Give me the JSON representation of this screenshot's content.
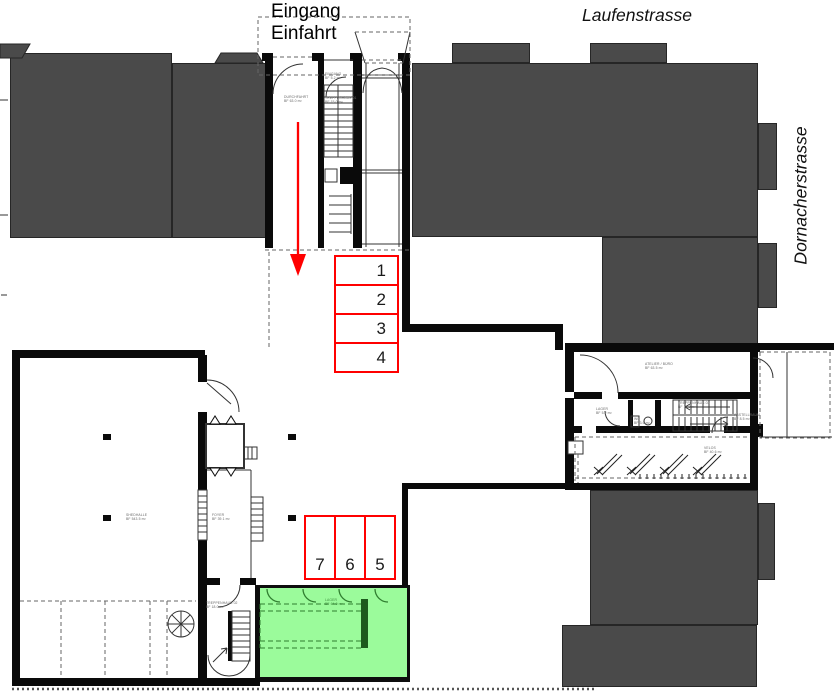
{
  "plan": {
    "entrance_label": "Eingang\nEinfahrt",
    "streets": {
      "top": "Laufenstrasse",
      "right": "Dornacherstrasse"
    },
    "parking_spots": [
      "1",
      "2",
      "3",
      "4",
      "5",
      "6",
      "7"
    ],
    "room_labels": {
      "eingang": "EINGANG\nBF 5.2 m²",
      "durchfahrt": "DURCHFAHRT\nBF 63.0 m²",
      "treppenhaus_nord": "TREPPENHAUS 01\nBF 15.0 m²",
      "shedhalle": "SHEDHALLE\nBF 543.5 m²",
      "foyer": "FOYER\nBF 39.1 m²",
      "treppenhaus_sued": "TREPPENHAUS 02\nBF 18.0 m²",
      "lager_gruen": "LAGER\nBF 64.0 m²",
      "atelier": "ATELIER / BÜRO\nBF 63.5 m²",
      "lager": "LAGER\nBF 5.2 m²",
      "wc": "WC\nBF 3.6 m²",
      "treppenhaus_ost": "TREPPENHAUS 03\nBF 19.0 m²",
      "abstellraum": "ABSTELLRAUM\nBF 8.5 m²",
      "velos": "VELOS\nBF 40.6 m²"
    },
    "colors": {
      "accent_red": "#ff0000",
      "highlight_green": "#9bfb9b",
      "building_gray": "#4a4a4a"
    }
  }
}
